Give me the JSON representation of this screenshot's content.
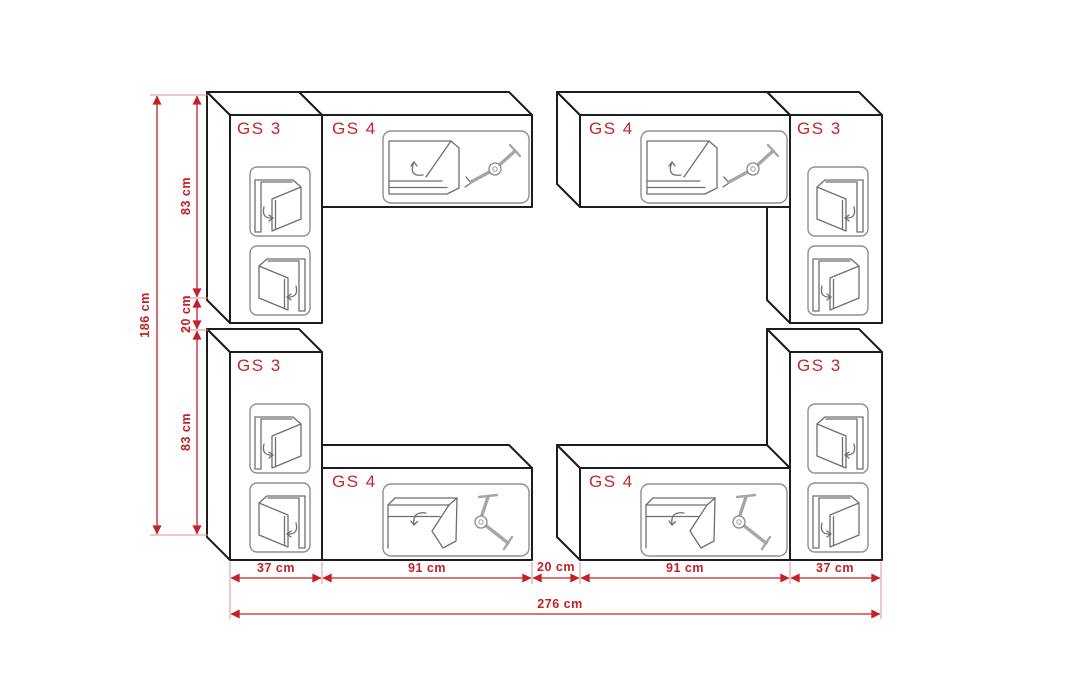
{
  "diagram_title": "Wall unit arrangement with dimensions",
  "colors": {
    "background": "#ffffff",
    "outline": "#1d1d1d",
    "icon_gray": "#8f8f8f",
    "label_red": "#c1272d",
    "dimension_red": "#c22127"
  },
  "cabinets": [
    {
      "key": "gs3-top-left",
      "label": "GS 3",
      "type": "tall-cabinet-two-doors"
    },
    {
      "key": "gs4-top-left",
      "label": "GS 4",
      "type": "wide-cabinet-flap"
    },
    {
      "key": "gs4-top-right",
      "label": "GS 4",
      "type": "wide-cabinet-flap"
    },
    {
      "key": "gs3-top-right",
      "label": "GS 3",
      "type": "tall-cabinet-two-doors"
    },
    {
      "key": "gs3-bottom-left",
      "label": "GS 3",
      "type": "tall-cabinet-two-doors"
    },
    {
      "key": "gs4-bottom-left",
      "label": "GS 4",
      "type": "wide-cabinet-flap"
    },
    {
      "key": "gs4-bottom-right",
      "label": "GS 4",
      "type": "wide-cabinet-flap"
    },
    {
      "key": "gs3-bottom-right",
      "label": "GS 3",
      "type": "tall-cabinet-two-doors"
    }
  ],
  "dimensions": {
    "left_total": "186 cm",
    "left_segments": [
      "83 cm",
      "20 cm",
      "83 cm"
    ],
    "bottom_segments": [
      "37 cm",
      "91 cm",
      "20 cm",
      "91 cm",
      "37 cm"
    ],
    "bottom_total": "276 cm"
  }
}
